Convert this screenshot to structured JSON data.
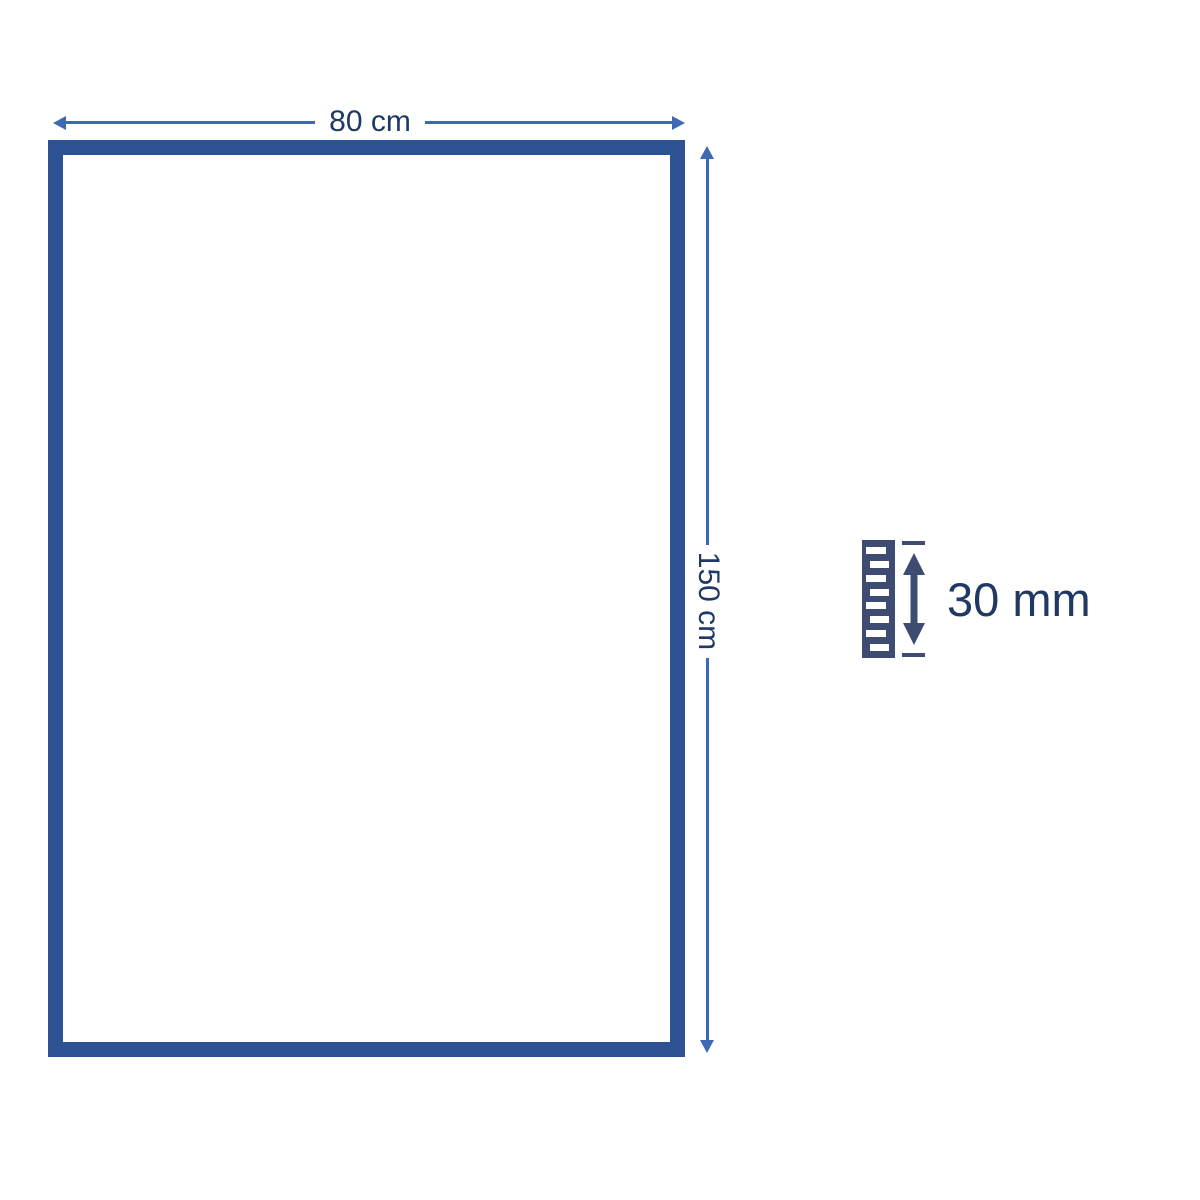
{
  "diagram": {
    "width_label": "80 cm",
    "height_label": "150 cm",
    "thickness_label": "30 mm"
  },
  "icons": {
    "width_arrow": "horizontal-double-arrow-icon",
    "height_arrow": "vertical-double-arrow-icon",
    "thickness_arrow": "vertical-double-arrow-icon",
    "pile": "pile-height-stripes-icon"
  },
  "colors": {
    "frame": "#2e5395",
    "dimension_line": "#3f68b4",
    "label_text": "#1f3864",
    "icon": "#3d4c70",
    "bg": "#ffffff"
  }
}
